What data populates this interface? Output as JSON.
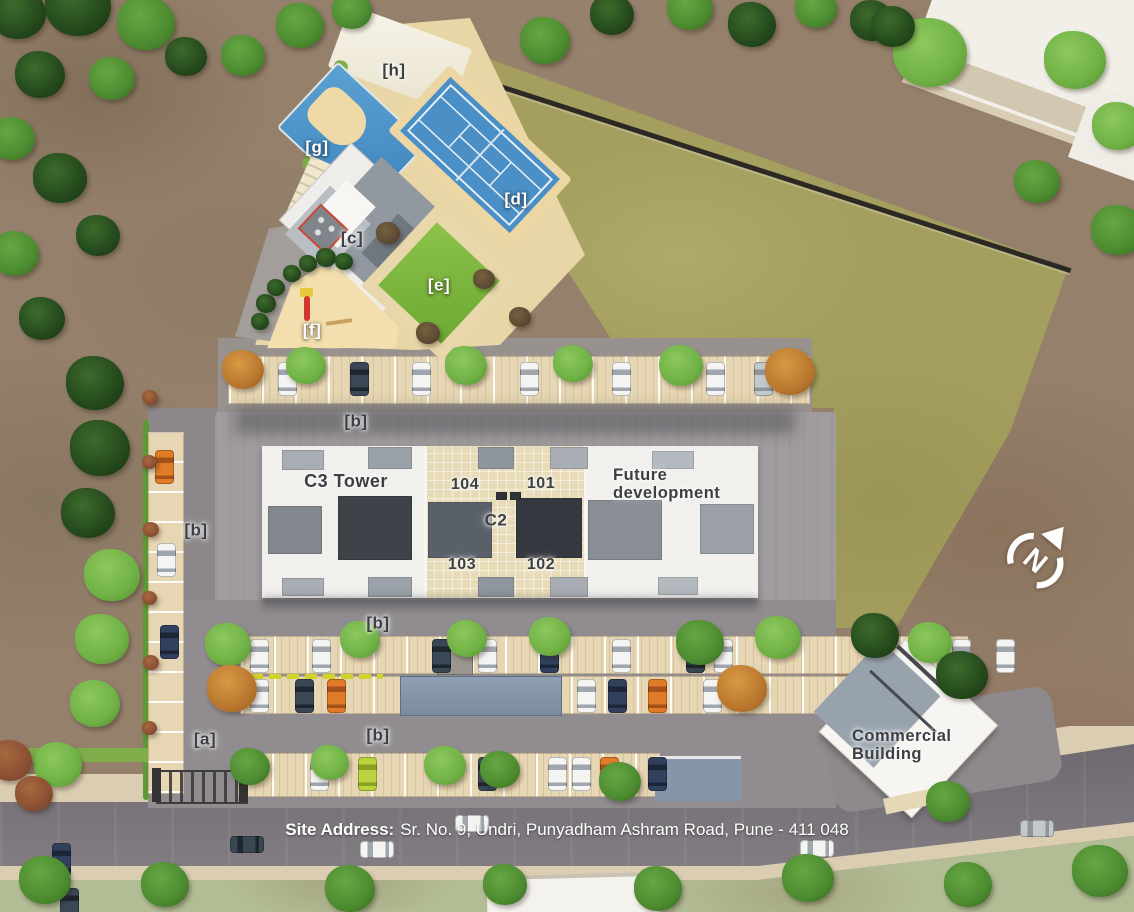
{
  "banner": {
    "label": "Site Address:",
    "address": "Sr. No. 9, Undri, Punyadham Ashram Road, Pune - 411 048"
  },
  "buildings": {
    "c3_tower": "C3 Tower",
    "c2": "C2",
    "unit_101": "101",
    "unit_102": "102",
    "unit_103": "103",
    "unit_104": "104",
    "future_development": "Future development",
    "commercial": "Commercial Building"
  },
  "markers": {
    "a": "[a]",
    "b": "[b]",
    "c": "[c]",
    "d": "[d]",
    "e": "[e]",
    "f": "[f]",
    "g": "[g]",
    "h": "[h]"
  },
  "compass": {
    "letter": "N"
  },
  "colors": {
    "pool_blue": "#4a92c8",
    "court_blue": "#4a8fc6",
    "lawn_green": "#7cb83e",
    "open_field_olive": "#a49f5e",
    "sand_play_area": "#f2dfad",
    "road_gray": "#7a757b",
    "label_dark": "#3c4044",
    "label_light": "#ffffff",
    "boundary_wall": "#2c2823"
  }
}
